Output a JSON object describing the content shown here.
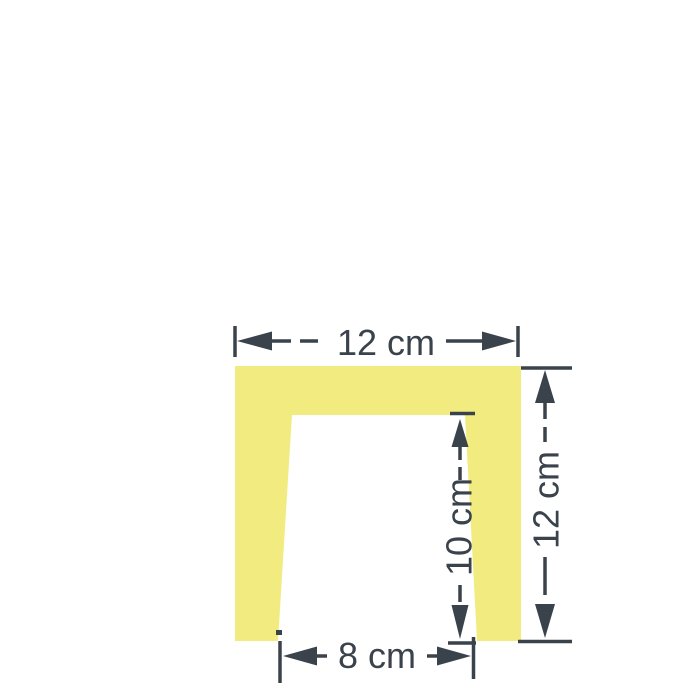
{
  "figure": {
    "title": "Square with trapezoidal cutout, dimensioned in centimetres",
    "shape_color": "#f2ec80",
    "ink_color": "#3a424b",
    "background_color": "#ffffff"
  },
  "dimensions": {
    "outer_width": {
      "label": "12 cm",
      "value_cm": 12,
      "orientation": "horizontal",
      "position": "top"
    },
    "outer_height": {
      "label": "12 cm",
      "value_cm": 12,
      "orientation": "vertical",
      "position": "right"
    },
    "cutout_height": {
      "label": "10 cm",
      "value_cm": 10,
      "orientation": "vertical",
      "position": "inside-cutout"
    },
    "cutout_width": {
      "label": "8 cm",
      "value_cm": 8,
      "orientation": "horizontal",
      "position": "bottom"
    }
  }
}
